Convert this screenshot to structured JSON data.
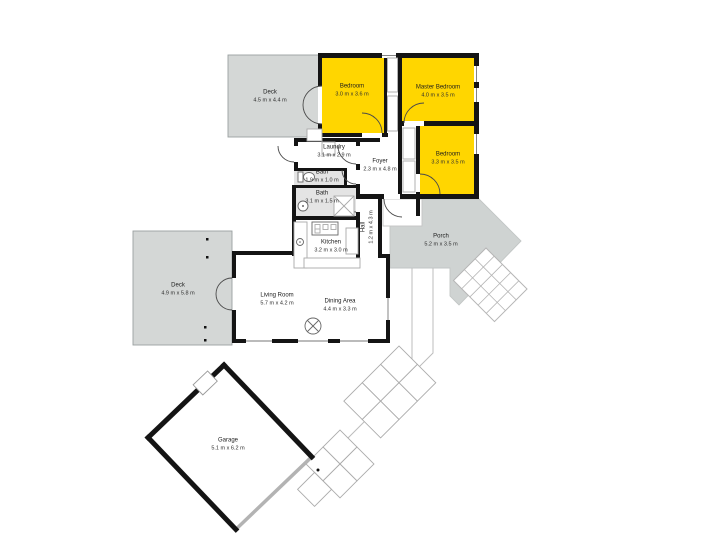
{
  "plan": {
    "rooms": [
      {
        "id": "deck-top",
        "name": "Deck",
        "dims": "4.5 m x 4.4 m",
        "highlighted": false
      },
      {
        "id": "bedroom-top",
        "name": "Bedroom",
        "dims": "3.0 m x 3.6 m",
        "highlighted": true
      },
      {
        "id": "master-bedroom",
        "name": "Master Bedroom",
        "dims": "4.0 m x 3.5 m",
        "highlighted": true
      },
      {
        "id": "bedroom-right",
        "name": "Bedroom",
        "dims": "3.3 m x 3.5 m",
        "highlighted": true
      },
      {
        "id": "laundry",
        "name": "Laundry",
        "dims": "3.1 m x 2.9 m",
        "highlighted": false
      },
      {
        "id": "bath-small",
        "name": "Bath",
        "dims": "1.9 m x 1.0 m",
        "highlighted": false
      },
      {
        "id": "bath-large",
        "name": "Bath",
        "dims": "3.1 m x 1.5 m",
        "highlighted": false
      },
      {
        "id": "foyer",
        "name": "Foyer",
        "dims": "2.3 m x 4.8 m",
        "highlighted": false
      },
      {
        "id": "hall",
        "name": "Hall",
        "dims": "1.2 m x 4.3 m",
        "highlighted": false
      },
      {
        "id": "kitchen",
        "name": "Kitchen",
        "dims": "3.2 m x 3.0 m",
        "highlighted": false
      },
      {
        "id": "living-room",
        "name": "Living Room",
        "dims": "5.7 m x 4.2 m",
        "highlighted": false
      },
      {
        "id": "dining-area",
        "name": "Dining Area",
        "dims": "4.4 m x 3.3 m",
        "highlighted": false
      },
      {
        "id": "deck-left",
        "name": "Deck",
        "dims": "4.9 m x 5.8 m",
        "highlighted": false
      },
      {
        "id": "porch",
        "name": "Porch",
        "dims": "5.2 m x 3.5 m",
        "highlighted": false
      },
      {
        "id": "garage",
        "name": "Garage",
        "dims": "5.1 m x 6.2 m",
        "highlighted": false
      }
    ],
    "fixtures": [
      "toilet",
      "shower",
      "basin",
      "sink",
      "stove",
      "fridge",
      "wood-burner",
      "stairs",
      "paver-path",
      "wardrobes"
    ]
  },
  "colors": {
    "highlight": "#ffd600",
    "deck": "#d4d7d6",
    "porch": "#cfd3d2",
    "bathfloor": "#e4e4e4",
    "wall": "#141414",
    "outline": "#b8b8b8"
  }
}
